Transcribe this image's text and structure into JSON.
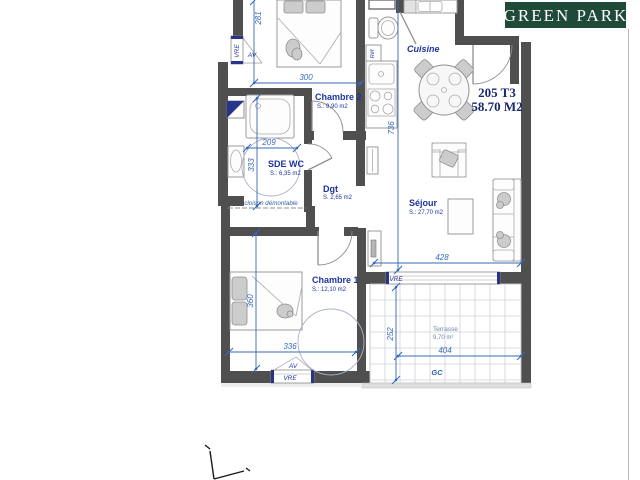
{
  "logo": {
    "text": "GREEN PARK",
    "bg_color": "#1f4a38",
    "text_color": "#ffffff"
  },
  "unit": {
    "id": "205 T3",
    "area": "58.70 M2"
  },
  "rooms": {
    "chambre2": {
      "name": "Chambre 2",
      "area": "S.: 9,90 m2"
    },
    "cuisine": {
      "name": "Cuisine"
    },
    "sde_wc": {
      "name": "SDE WC",
      "area": "S.: 6,35 m2"
    },
    "degagement": {
      "name": "Dgt",
      "area": "S. 2,65 m2"
    },
    "sejour": {
      "name": "Séjour",
      "area": "S.: 27,70 m2"
    },
    "chambre1": {
      "name": "Chambre 1",
      "area": "S.: 12,10 m2"
    },
    "terrasse": {
      "name": "Terrasse",
      "area": "9,70 m²"
    }
  },
  "dimensions_cm": {
    "chambre2_height": "281",
    "chambre2_width": "300",
    "sde_width": "209",
    "sde_height": "333",
    "sejour_height": "736",
    "sejour_width": "428",
    "chambre1_height": "360",
    "chambre1_width": "336",
    "terrasse_height": "252",
    "terrasse_width": "404"
  },
  "annotations": {
    "vre": "VRE",
    "av": "AV",
    "ref": "Réf",
    "gc": "GC",
    "cloison": "cloison démontable"
  },
  "colors": {
    "wall_gray": "#4f4f4f",
    "dimension_blue": "#3568b8",
    "label_navy": "#1d34a0",
    "unit_navy": "#18286e",
    "logo_green": "#1f4a38",
    "terrasse_text": "#6b86ab"
  }
}
